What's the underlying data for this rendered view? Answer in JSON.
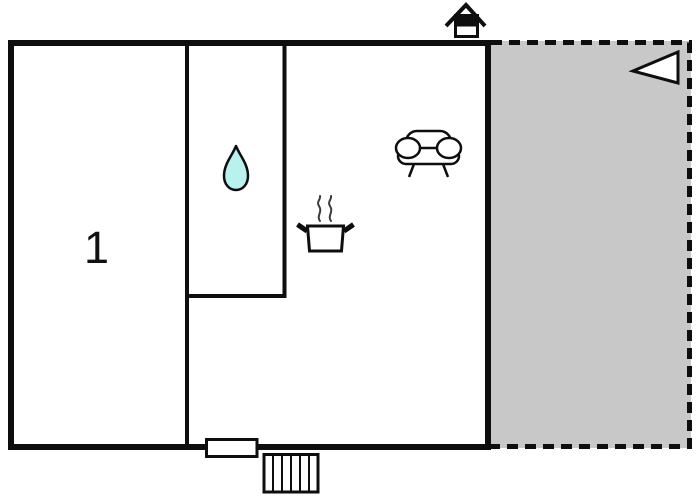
{
  "floorplan": {
    "room_label": "1",
    "colors": {
      "wall": "#0e0e0e",
      "terrace_fill": "#c8c8c8",
      "water_drop_fill": "#b9f1ef",
      "steam": "#3a3a3a",
      "background": "#ffffff"
    },
    "icons": [
      "chimney-icon",
      "direction-arrow-icon",
      "sofa-icon",
      "water-drop-icon",
      "cooking-pot-icon",
      "window-marker",
      "stairs-icon"
    ]
  }
}
